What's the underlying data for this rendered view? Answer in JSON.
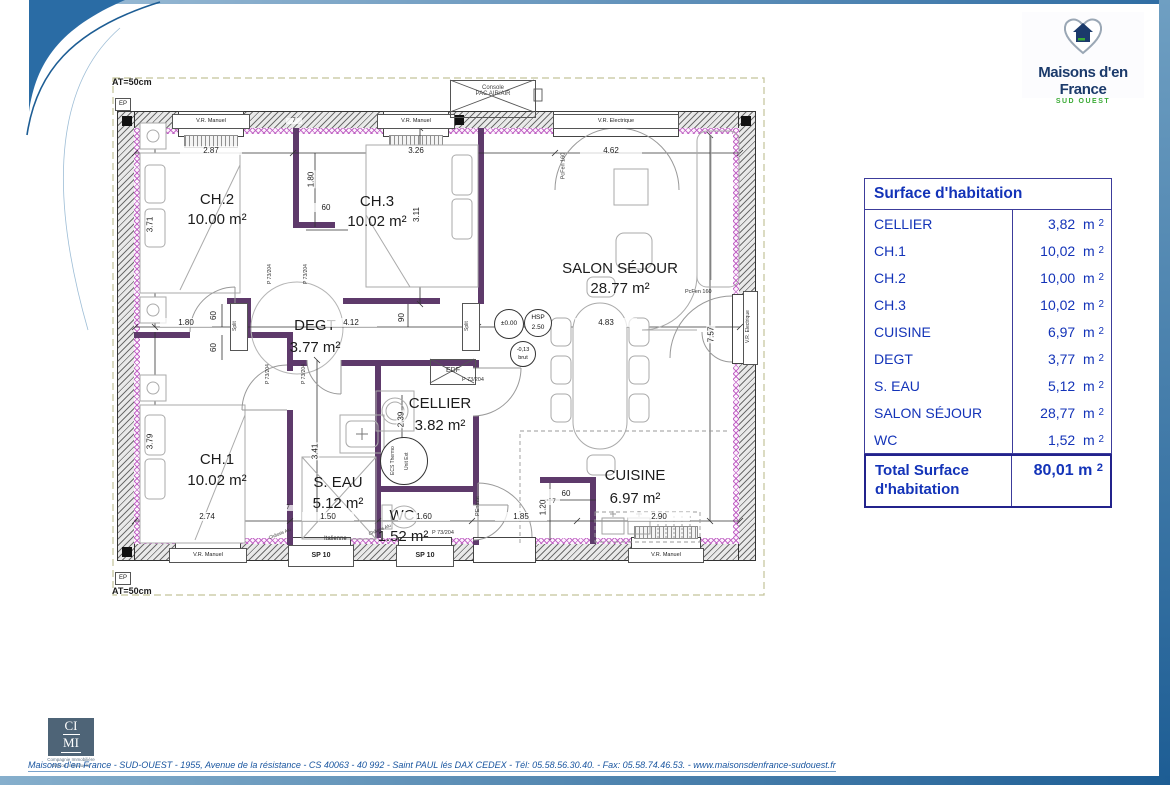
{
  "branding": {
    "logo_title": "Maisons d'en France",
    "logo_subtitle": "SUD OUEST",
    "cimi_line1": "CI",
    "cimi_line2": "MI",
    "cimi_caption1": "Compagnie Immobilière",
    "cimi_caption2": "Maison Individuelle"
  },
  "footer": {
    "text": "Maisons d'en France - SUD-OUEST - 1955, Avenue de la résistance - CS 40063 - 40 992 - Saint PAUL lés DAX CEDEX - Tél: 05.58.56.30.40. - Fax: 05.58.74.46.53. -  www.maisonsdenfrance-sudouest.fr"
  },
  "surface_table": {
    "title": "Surface d'habitation",
    "unit": "m",
    "sup": "2",
    "rows": [
      {
        "label": "CELLIER",
        "value": "3,82"
      },
      {
        "label": "CH.1",
        "value": "10,02"
      },
      {
        "label": "CH.2",
        "value": "10,00"
      },
      {
        "label": "CH.3",
        "value": "10,02"
      },
      {
        "label": "CUISINE",
        "value": "6,97"
      },
      {
        "label": "DEGT",
        "value": "3,77"
      },
      {
        "label": "S. EAU",
        "value": "5,12"
      },
      {
        "label": "SALON SÉJOUR",
        "value": "28,77"
      },
      {
        "label": "WC",
        "value": "1,52"
      }
    ],
    "total_label": "Total Surface d'habitation",
    "total_value": "80,01"
  },
  "plan": {
    "rooms": [
      {
        "name": "CH.2",
        "area": "10.00 m²"
      },
      {
        "name": "CH.3",
        "area": "10.02 m²"
      },
      {
        "name": "SALON SÉJOUR",
        "area": "28.77 m²"
      },
      {
        "name": "DEGT",
        "area": "3.77 m²"
      },
      {
        "name": "CELLIER",
        "area": "3.82 m²"
      },
      {
        "name": "CH.1",
        "area": "10.02 m²"
      },
      {
        "name": "S. EAU",
        "area": "5.12 m²"
      },
      {
        "name": "WC",
        "area": "1.52 m²"
      },
      {
        "name": "CUISINE",
        "area": "6.97 m²"
      }
    ],
    "dims": {
      "d287": "2.87",
      "d326": "3.26",
      "d462": "4.62",
      "d371": "3.71",
      "d311": "3.11",
      "d180": "1.80",
      "d60": "60",
      "d412": "4.12",
      "d90": "90",
      "d483": "4.83",
      "d757": "7.57",
      "d341": "3.41",
      "d239": "2.39",
      "d379": "3.79",
      "d274": "2.74",
      "d150": "1.50",
      "d160": "1.60",
      "d185": "1.85",
      "d290": "2.90",
      "d120": "1.20",
      "d7": "7"
    },
    "labels": {
      "at": "AT=50cm",
      "ep": "EP",
      "vr_manuel": "V.R. Manuel",
      "vr_electrique": "V.R. Electrique",
      "pac1": "Console",
      "pac2": "PAC AIR/AIR",
      "split": "Split",
      "p73": "P 73/204",
      "edf": "EDF",
      "ecs1": "ECS Thermo",
      "ecs2": "Unit Ext",
      "sp10": "SP 10",
      "italienne": "Italienne",
      "chassis": "Châssis Alu",
      "pcfen": "PcFen 160",
      "pentree": "PEntrée",
      "level0": "±0.00",
      "hsp1": "HSP",
      "hsp2": "2.50",
      "niv1": "-0,13",
      "niv2": "brut"
    }
  }
}
